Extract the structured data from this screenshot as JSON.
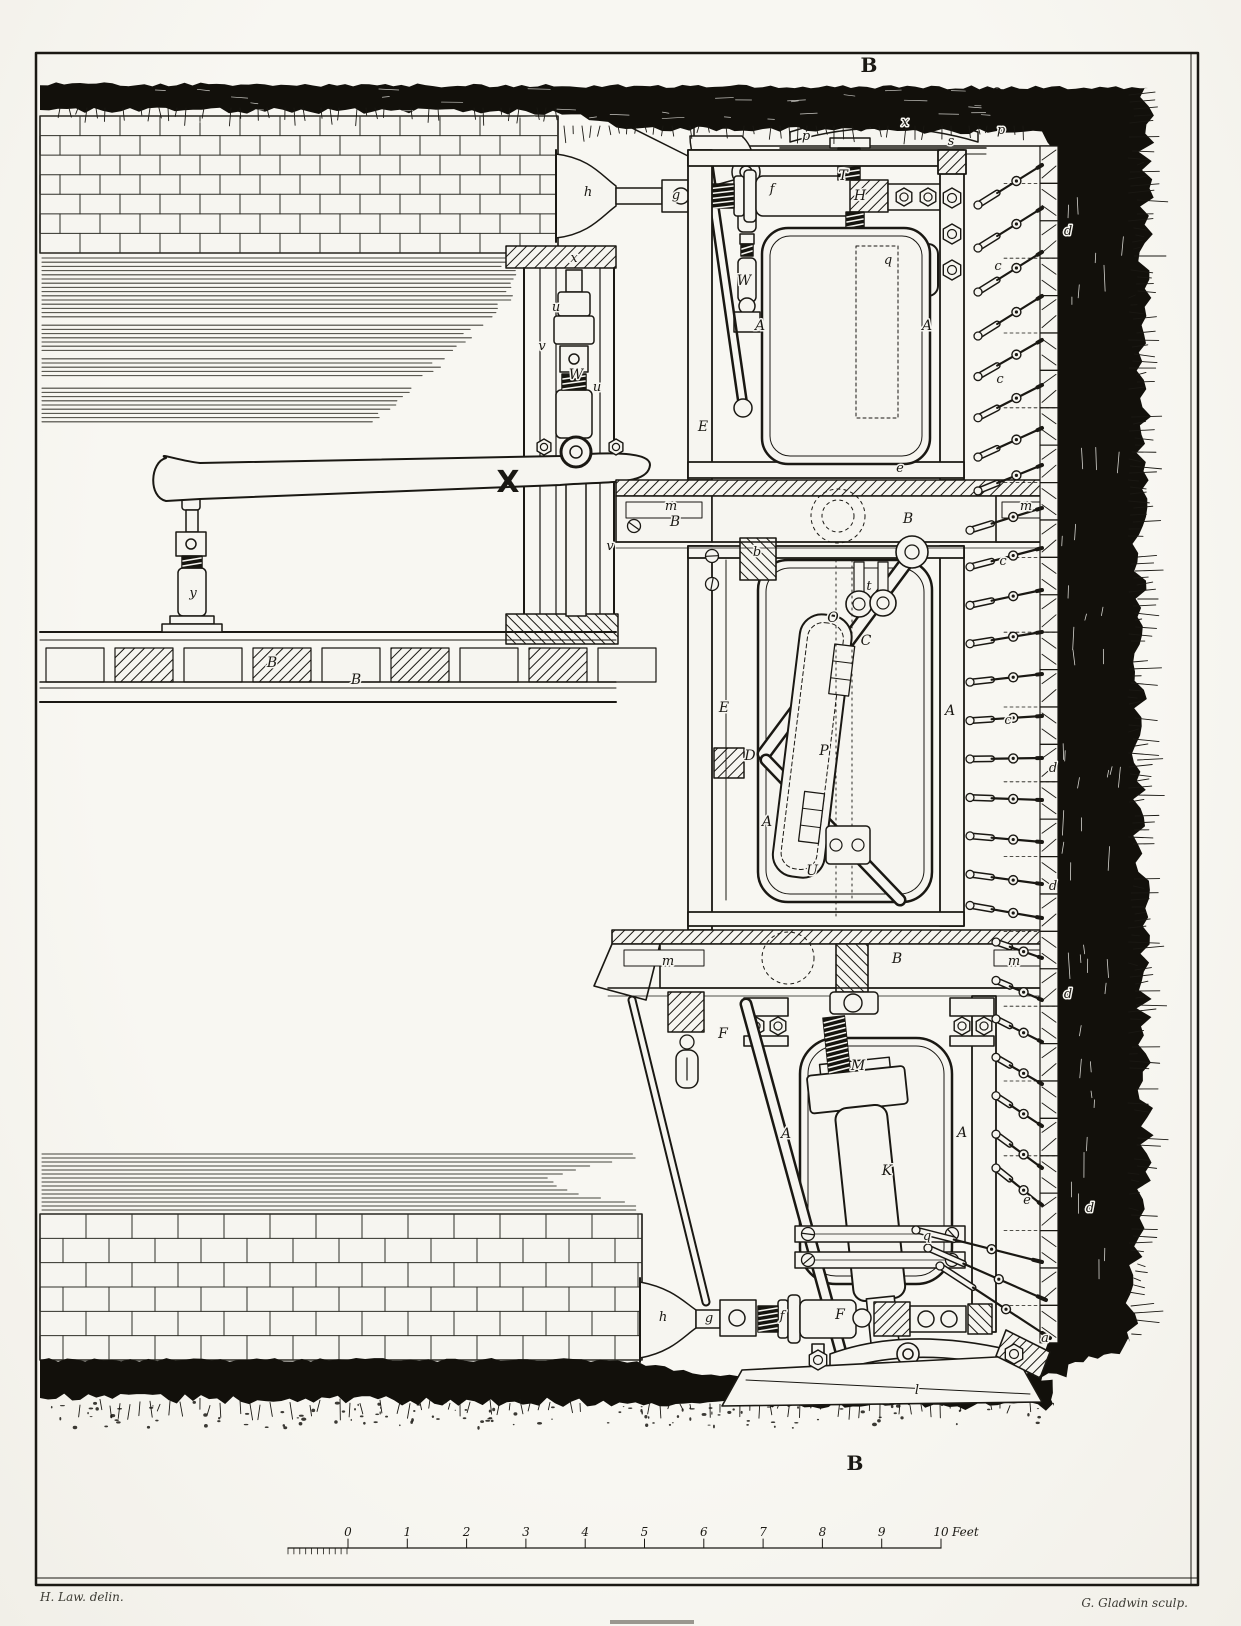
{
  "colors": {
    "paper": "#f6f5f0",
    "ink": "#1a1813",
    "earth": "#12100b",
    "shading": "#45443c"
  },
  "plate": {
    "section_mark_top": "B",
    "section_mark_bottom": "B",
    "highlight_mark": "X",
    "credit_left": "H. Law. delin.",
    "credit_right": "G. Gladwin sculp."
  },
  "scale_bar": {
    "numbers": [
      "0",
      "1",
      "2",
      "3",
      "4",
      "5",
      "6",
      "7",
      "8",
      "9",
      "10"
    ],
    "unit": "Feet"
  },
  "part_labels": [
    {
      "t": "h",
      "x": 588,
      "y": 196
    },
    {
      "t": "g",
      "x": 676,
      "y": 199
    },
    {
      "t": "f",
      "x": 772,
      "y": 193
    },
    {
      "t": "T",
      "x": 843,
      "y": 180
    },
    {
      "t": "H",
      "x": 860,
      "y": 200
    },
    {
      "t": "p",
      "x": 806,
      "y": 140
    },
    {
      "t": "x",
      "x": 905,
      "y": 126
    },
    {
      "t": "s",
      "x": 951,
      "y": 145
    },
    {
      "t": "p",
      "x": 1001,
      "y": 134
    },
    {
      "t": "W",
      "x": 744,
      "y": 285
    },
    {
      "t": "q",
      "x": 888,
      "y": 264
    },
    {
      "t": "A",
      "x": 760,
      "y": 330
    },
    {
      "t": "A",
      "x": 927,
      "y": 330
    },
    {
      "t": "E",
      "x": 703,
      "y": 431
    },
    {
      "t": "x",
      "x": 574,
      "y": 262
    },
    {
      "t": "u",
      "x": 556,
      "y": 311
    },
    {
      "t": "v",
      "x": 542,
      "y": 350
    },
    {
      "t": "W",
      "x": 576,
      "y": 379
    },
    {
      "t": "u",
      "x": 597,
      "y": 391
    },
    {
      "t": "v",
      "x": 610,
      "y": 550
    },
    {
      "t": "y",
      "x": 193,
      "y": 597
    },
    {
      "t": "B",
      "x": 272,
      "y": 667
    },
    {
      "t": "B",
      "x": 356,
      "y": 684
    },
    {
      "t": "m",
      "x": 671,
      "y": 510
    },
    {
      "t": "B",
      "x": 675,
      "y": 526
    },
    {
      "t": "B",
      "x": 908,
      "y": 523
    },
    {
      "t": "m",
      "x": 1026,
      "y": 510
    },
    {
      "t": "b",
      "x": 757,
      "y": 556
    },
    {
      "t": "e",
      "x": 900,
      "y": 472
    },
    {
      "t": "t",
      "x": 869,
      "y": 590
    },
    {
      "t": "O",
      "x": 833,
      "y": 622
    },
    {
      "t": "C",
      "x": 866,
      "y": 645
    },
    {
      "t": "E",
      "x": 724,
      "y": 712
    },
    {
      "t": "A",
      "x": 950,
      "y": 715
    },
    {
      "t": "D",
      "x": 750,
      "y": 760
    },
    {
      "t": "P",
      "x": 824,
      "y": 755
    },
    {
      "t": "A",
      "x": 767,
      "y": 826
    },
    {
      "t": "U",
      "x": 812,
      "y": 875
    },
    {
      "t": "m",
      "x": 668,
      "y": 965
    },
    {
      "t": "B",
      "x": 897,
      "y": 963
    },
    {
      "t": "m",
      "x": 1014,
      "y": 965
    },
    {
      "t": "F",
      "x": 723,
      "y": 1038
    },
    {
      "t": "M",
      "x": 858,
      "y": 1070
    },
    {
      "t": "A",
      "x": 786,
      "y": 1138
    },
    {
      "t": "A",
      "x": 962,
      "y": 1137
    },
    {
      "t": "K",
      "x": 887,
      "y": 1175
    },
    {
      "t": "q",
      "x": 927,
      "y": 1240
    },
    {
      "t": "h",
      "x": 663,
      "y": 1321
    },
    {
      "t": "g",
      "x": 709,
      "y": 1322
    },
    {
      "t": "f",
      "x": 782,
      "y": 1320
    },
    {
      "t": "F",
      "x": 840,
      "y": 1319
    },
    {
      "t": "l",
      "x": 917,
      "y": 1394
    },
    {
      "t": "a",
      "x": 1045,
      "y": 1342
    },
    {
      "t": "c",
      "x": 998,
      "y": 270
    },
    {
      "t": "c",
      "x": 1000,
      "y": 383
    },
    {
      "t": "c",
      "x": 1003,
      "y": 565
    },
    {
      "t": "c",
      "x": 1008,
      "y": 724
    },
    {
      "t": "d",
      "x": 1068,
      "y": 235
    },
    {
      "t": "d",
      "x": 1053,
      "y": 772
    },
    {
      "t": "d",
      "x": 1053,
      "y": 890
    },
    {
      "t": "d",
      "x": 1068,
      "y": 998
    },
    {
      "t": "d",
      "x": 1090,
      "y": 1212
    },
    {
      "t": "e",
      "x": 1027,
      "y": 1204
    }
  ]
}
